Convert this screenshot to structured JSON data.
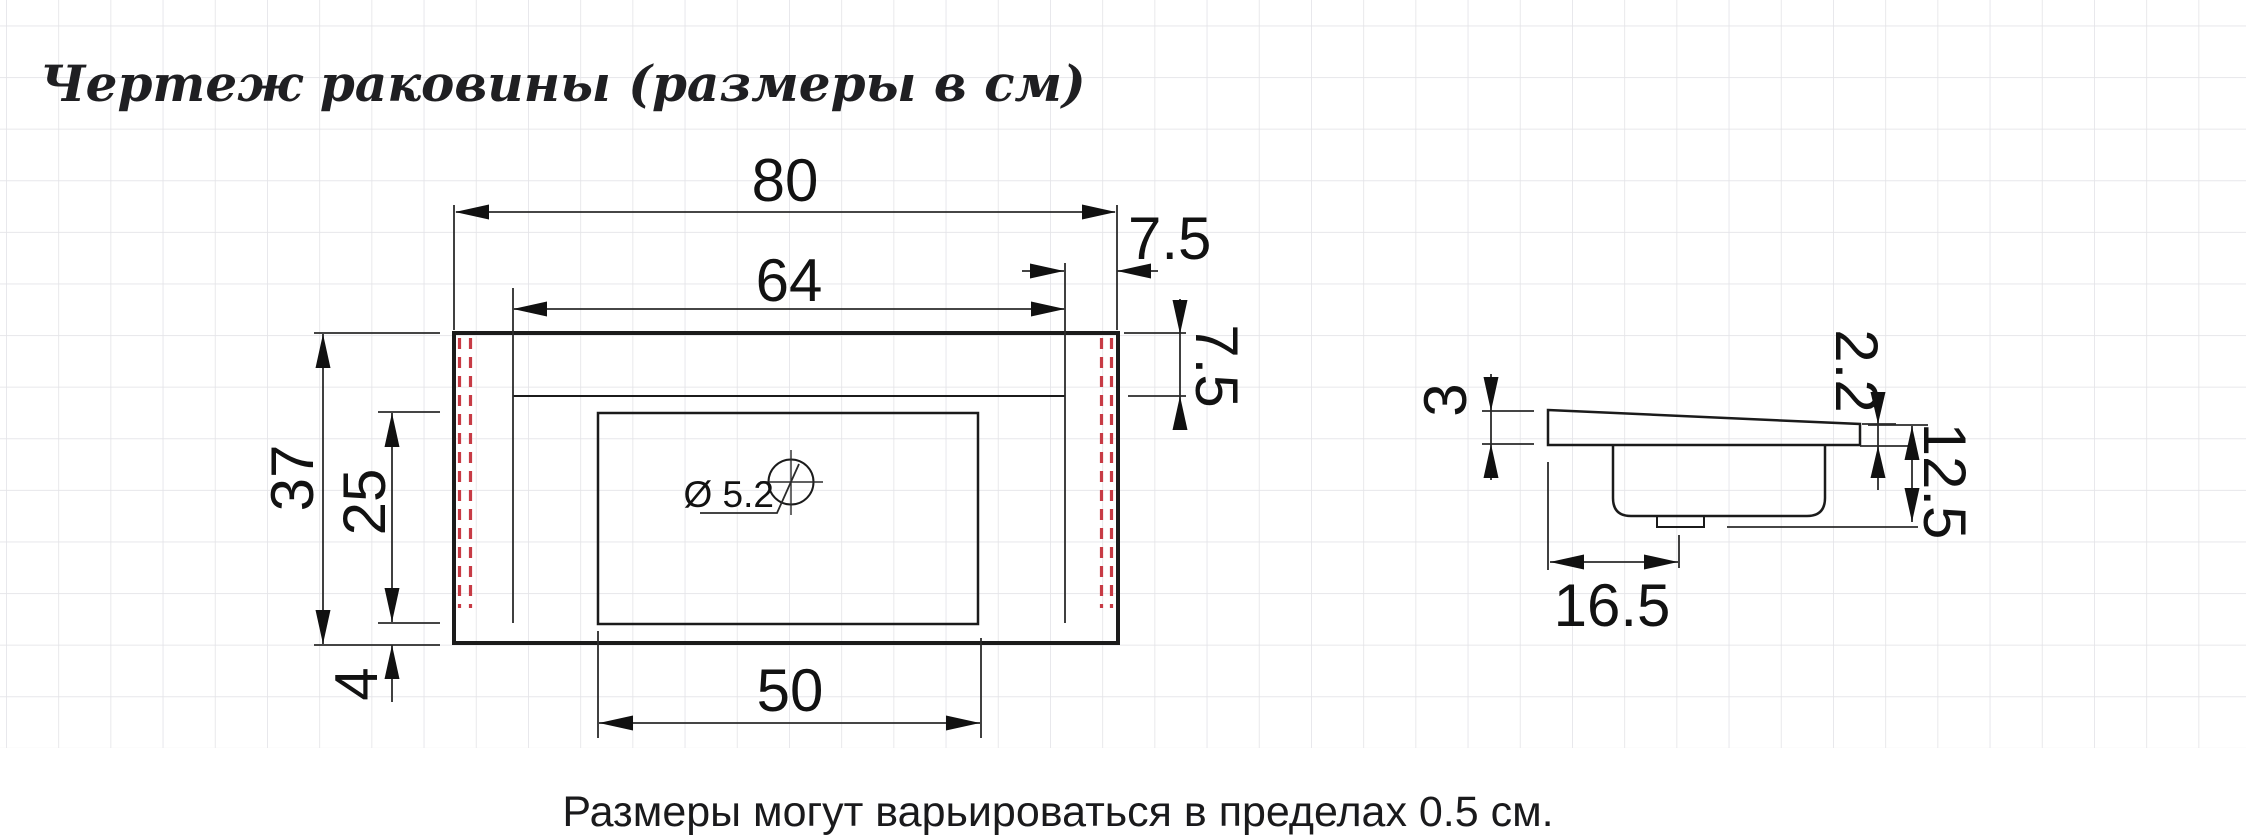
{
  "title": "Чертеж раковины (размеры в см)",
  "footnote": "Размеры могут варьироваться в пределах 0.5 см.",
  "colors": {
    "ink": "#1b1b1b",
    "mounting_red": "#c73b45",
    "grid_line": "#e4e4e8",
    "background": "#ffffff"
  },
  "plan_view": {
    "total_width": "80",
    "inner_width": "64",
    "right_offset": "7.5",
    "rim_depth": "7.5",
    "total_depth": "37",
    "basin_depth": "25",
    "front_gap": "4",
    "basin_width": "50",
    "hole_diameter": "Ø 5.2"
  },
  "side_view": {
    "left_edge_thickness": "3",
    "right_edge_thickness": "2.2",
    "total_height": "12.5",
    "drain_offset": "16.5"
  }
}
